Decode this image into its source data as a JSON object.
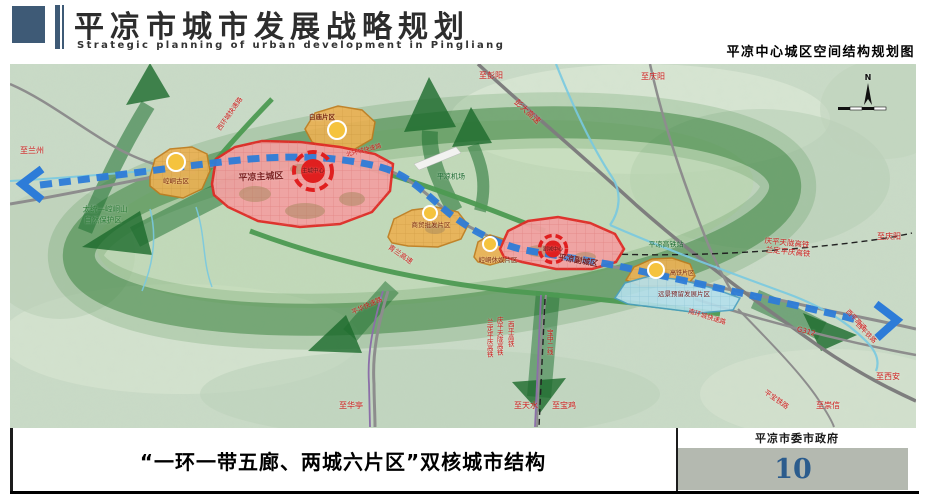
{
  "header": {
    "title": "平凉市城市发展战略规划",
    "subtitle_en": "Strategic planning of urban development in Pingliang",
    "map_title": "平凉中心城区空间结构规划图"
  },
  "footer": {
    "caption": "“一环一带五廊、两城六片区”双核城市结构",
    "agency": "平凉市委市政府",
    "page_number": "10"
  },
  "colors": {
    "header_accent": "#3e5a76",
    "eco_ring_green": "#35803a",
    "corridor_green": "#1b6a2c",
    "belt_blue": "#2d7cd8",
    "main_city_red": "#e02b26",
    "district_orange": "#ebb255",
    "reserve_cyan": "#b5e0ec",
    "page_number_blue": "#2b5c8d"
  },
  "map": {
    "labels": [
      {
        "name": "label-to-lanzhou",
        "text": "至兰州",
        "x": 32,
        "y": 151,
        "color": "#cf1d1d",
        "size": 8,
        "rot": 0
      },
      {
        "name": "label-west-ring-expressway",
        "text": "西环城快速路",
        "x": 230,
        "y": 114,
        "color": "#cf1d1d",
        "size": 6.5,
        "rot": -55
      },
      {
        "name": "label-to-pengyang",
        "text": "至彭阳",
        "x": 491,
        "y": 76,
        "color": "#cf1d1d",
        "size": 8,
        "rot": 0
      },
      {
        "name": "label-to-qingyang-top",
        "text": "至庆阳",
        "x": 653,
        "y": 77,
        "color": "#cf1d1d",
        "size": 8,
        "rot": 0
      },
      {
        "name": "label-pengda-expressway",
        "text": "彭大高速",
        "x": 527,
        "y": 112,
        "color": "#cf1d1d",
        "size": 8,
        "rot": 42
      },
      {
        "name": "label-baimiao-district",
        "text": "白庙片区",
        "x": 322,
        "y": 117,
        "color": "#7c2a12",
        "size": 6.5,
        "rot": 0,
        "bold": true
      },
      {
        "name": "label-north-ring-expressway",
        "text": "北环城快速路",
        "x": 364,
        "y": 151,
        "color": "#cf1d1d",
        "size": 6,
        "rot": -15
      },
      {
        "name": "label-pingliang-airport",
        "text": "平凉机场",
        "x": 451,
        "y": 177,
        "color": "#1e6b33",
        "size": 7,
        "rot": 0
      },
      {
        "name": "label-main-city",
        "text": "平凉主城区",
        "x": 261,
        "y": 178,
        "color": "#7a1f1f",
        "size": 9,
        "rot": -3,
        "bold": true
      },
      {
        "name": "label-main-city-center",
        "text": "主城中心",
        "x": 313,
        "y": 172,
        "color": "#5c0f0f",
        "size": 5.5,
        "rot": 0
      },
      {
        "name": "label-kongtong-old-district",
        "text": "崆峒古区",
        "x": 176,
        "y": 181,
        "color": "#7c2a12",
        "size": 6.5,
        "rot": 0
      },
      {
        "name": "label-nature-reserve-line1",
        "text": "太统—崆峒山",
        "x": 105,
        "y": 209,
        "color": "#2f7d3a",
        "size": 7.5,
        "rot": 0
      },
      {
        "name": "label-nature-reserve-line2",
        "text": "自然保护区",
        "x": 103,
        "y": 220,
        "color": "#2f7d3a",
        "size": 7.5,
        "rot": 0
      },
      {
        "name": "label-qinglan-expressway",
        "text": "青兰高速",
        "x": 400,
        "y": 255,
        "color": "#cf1d1d",
        "size": 7,
        "rot": 35
      },
      {
        "name": "label-trade-wholesale-district",
        "text": "商贸批发片区",
        "x": 431,
        "y": 225,
        "color": "#7c2a12",
        "size": 6.5,
        "rot": 0
      },
      {
        "name": "label-leisure-district",
        "text": "崆峒休娱片区",
        "x": 498,
        "y": 260,
        "color": "#7c2a12",
        "size": 6.5,
        "rot": 0
      },
      {
        "name": "label-sub-city",
        "text": "平凉副城区",
        "x": 578,
        "y": 261,
        "color": "#7a1f1f",
        "size": 8,
        "rot": 10,
        "bold": true
      },
      {
        "name": "label-sub-city-center",
        "text": "副城中心",
        "x": 553,
        "y": 250,
        "color": "#5c0f0f",
        "size": 5,
        "rot": 0
      },
      {
        "name": "label-hsr-station",
        "text": "平凉高铁站",
        "x": 666,
        "y": 245,
        "color": "#1e6b33",
        "size": 7,
        "rot": 0
      },
      {
        "name": "label-qingping-tianlong-hsr",
        "text": "庆平天陇高铁",
        "x": 787,
        "y": 243,
        "color": "#cf1d1d",
        "size": 7.5,
        "rot": 6
      },
      {
        "name": "label-landing-pingqing-hsr",
        "text": "兰定平庆高铁",
        "x": 788,
        "y": 252,
        "color": "#cf1d1d",
        "size": 7.5,
        "rot": 6
      },
      {
        "name": "label-to-qingyang-right",
        "text": "至庆阳",
        "x": 889,
        "y": 237,
        "color": "#cf1d1d",
        "size": 8,
        "rot": 0
      },
      {
        "name": "label-hsr-district",
        "text": "高铁片区",
        "x": 682,
        "y": 274,
        "color": "#7c2a12",
        "size": 6,
        "rot": 0
      },
      {
        "name": "label-reserved-development-district",
        "text": "远景预留发展片区",
        "x": 684,
        "y": 294,
        "color": "#7a1f1f",
        "size": 6.5,
        "rot": 0
      },
      {
        "name": "label-south-ring-expressway",
        "text": "南环城快速路",
        "x": 707,
        "y": 317,
        "color": "#cf1d1d",
        "size": 6.5,
        "rot": 17
      },
      {
        "name": "label-g312",
        "text": "G312",
        "x": 806,
        "y": 332,
        "color": "#cf1d1d",
        "size": 7,
        "rot": 15
      },
      {
        "name": "label-xiping-expressway",
        "text": "西平高速",
        "x": 856,
        "y": 320,
        "color": "#cf1d1d",
        "size": 6.5,
        "rot": 45
      },
      {
        "name": "label-xiping-railway",
        "text": "西平铁路",
        "x": 866,
        "y": 333,
        "color": "#cf1d1d",
        "size": 6.5,
        "rot": 45
      },
      {
        "name": "label-to-xian",
        "text": "至西安",
        "x": 888,
        "y": 377,
        "color": "#cf1d1d",
        "size": 8,
        "rot": 0
      },
      {
        "name": "label-to-chongxin",
        "text": "至崇信",
        "x": 828,
        "y": 406,
        "color": "#cf1d1d",
        "size": 8,
        "rot": 0
      },
      {
        "name": "label-pingbao-railway",
        "text": "平宝铁路",
        "x": 776,
        "y": 400,
        "color": "#cf1d1d",
        "size": 7,
        "rot": 35
      },
      {
        "name": "label-to-huating",
        "text": "至华亭",
        "x": 351,
        "y": 406,
        "color": "#cf1d1d",
        "size": 8,
        "rot": 0
      },
      {
        "name": "label-pinghua-expressway",
        "text": "平华快速路",
        "x": 367,
        "y": 306,
        "color": "#cf1d1d",
        "size": 6.5,
        "rot": -25
      },
      {
        "name": "label-landing-pingqing-hsr-vertical",
        "text": "兰定平庆高铁",
        "x": 489,
        "y": 338,
        "color": "#cf1d1d",
        "size": 6.5,
        "rot": 0,
        "vertical": true
      },
      {
        "name": "label-qingping-tianlong-hsr-vertical",
        "text": "庆平天陇高铁",
        "x": 499,
        "y": 336,
        "color": "#cf1d1d",
        "size": 6.5,
        "rot": 0,
        "vertical": true
      },
      {
        "name": "label-xiping-hsr-vertical",
        "text": "西平高铁",
        "x": 510,
        "y": 334,
        "color": "#cf1d1d",
        "size": 6.5,
        "rot": 0,
        "vertical": true
      },
      {
        "name": "label-baozhong-second-line",
        "text": "宝中二线",
        "x": 549,
        "y": 342,
        "color": "#cf1d1d",
        "size": 6.5,
        "rot": 0,
        "vertical": true
      },
      {
        "name": "label-to-tianshui",
        "text": "至天水",
        "x": 526,
        "y": 406,
        "color": "#cf1d1d",
        "size": 8,
        "rot": 0
      },
      {
        "name": "label-to-baoji",
        "text": "至宝鸡",
        "x": 564,
        "y": 406,
        "color": "#cf1d1d",
        "size": 8,
        "rot": 0
      },
      {
        "name": "compass-north-letter",
        "text": "N",
        "x": 868,
        "y": 78,
        "color": "#111111",
        "size": 8,
        "rot": 0,
        "bold": true
      }
    ]
  }
}
